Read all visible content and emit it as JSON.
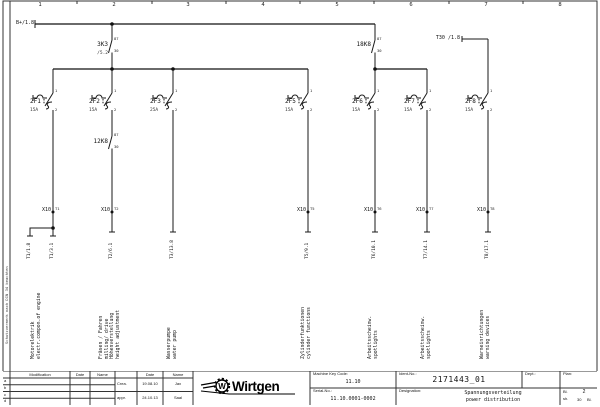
{
  "colors": {
    "line": "#1a1a1a",
    "bus": "#555555",
    "paper": "#ffffff"
  },
  "ruler": [
    "1",
    "2",
    "3",
    "4",
    "5",
    "6",
    "7",
    "8"
  ],
  "bus": {
    "label": "B+/1.8"
  },
  "t30": {
    "label": "T30 /1.8"
  },
  "relays": [
    {
      "id": "3K3",
      "ref": "/5.2",
      "pin_top": "87",
      "pin_bottom": "30"
    },
    {
      "id": "12K8",
      "pin_top": "87",
      "pin_bottom": "30"
    },
    {
      "id": "18K8",
      "pin_top": "87",
      "pin_bottom": "30"
    }
  ],
  "fuse_pins": {
    "top": "1",
    "bottom": "2"
  },
  "fuses": [
    {
      "id": "2F1",
      "rating": "15A"
    },
    {
      "id": "2F2",
      "rating": "15A"
    },
    {
      "id": "2F3",
      "rating": "25A"
    },
    {
      "id": "2F5",
      "rating": "15A"
    },
    {
      "id": "2F6",
      "rating": "15A"
    },
    {
      "id": "2F7",
      "rating": "15A"
    },
    {
      "id": "2F8",
      "rating": "15A"
    }
  ],
  "terminals": {
    "name": "X10",
    "pins": [
      "T1",
      "T2",
      "T5",
      "T6",
      "T7",
      "T8"
    ]
  },
  "wire_labels": [
    "T1/1.8",
    "T1/3.1",
    "T2/6.1",
    "T3/13.8",
    "T5/9.1",
    "T6/10.1",
    "T7/14.1",
    "T8/17.1"
  ],
  "functions": [
    {
      "lines": [
        "Motorelektrik",
        "electr.compon.of engine"
      ]
    },
    {
      "lines": [
        "Fräsen / Fahren",
        "milling/ drive",
        "Höhenverstellung",
        "height adjustment"
      ]
    },
    {
      "lines": [
        "Wasserpumpe",
        "water pump"
      ]
    },
    {
      "lines": [
        "Zylinderfunktionen",
        "cylinder functions"
      ]
    },
    {
      "lines": [
        "Arbeitsscheinw.",
        "spotlights"
      ]
    },
    {
      "lines": [
        "Arbeitsscheinw.",
        "spotlights"
      ]
    },
    {
      "lines": [
        "Warneinrichtungen",
        "warning devices"
      ]
    }
  ],
  "margin_note": "Schutzvermerk nach DIN 34 beachten",
  "title_block": {
    "mod_table": {
      "headers": [
        "Modification",
        "Date",
        "Name"
      ],
      "rows": [
        "a",
        "b",
        "c",
        "d"
      ]
    },
    "sign_table": {
      "date_header": "Date",
      "name_header": "Name",
      "rows": [
        {
          "label": "Crea.",
          "date": "19.08.10",
          "name": "Jax"
        },
        {
          "label": "appr.",
          "date": "24.10.13",
          "name": "Saal"
        }
      ]
    },
    "brand": "Wirtgen",
    "machine_key_code": {
      "label": "Machine Key Code:",
      "value": "11.10"
    },
    "serial_no": {
      "label": "Serial-No.:",
      "value": "11.10.0001-0002"
    },
    "ident_no": {
      "label": "Ident-No.:",
      "value": "2171443_01"
    },
    "designation": {
      "label": "Designation:",
      "value_de": "Spannungsverteilung",
      "value_en": "power distribution"
    },
    "dept": {
      "label": "Dept.:"
    },
    "plan": {
      "label": "Plan:"
    },
    "sheet": {
      "bl_label": "Bl.",
      "sh_label": "sh.",
      "number": "2",
      "total": "30",
      "total_suffix": "Bl."
    }
  }
}
